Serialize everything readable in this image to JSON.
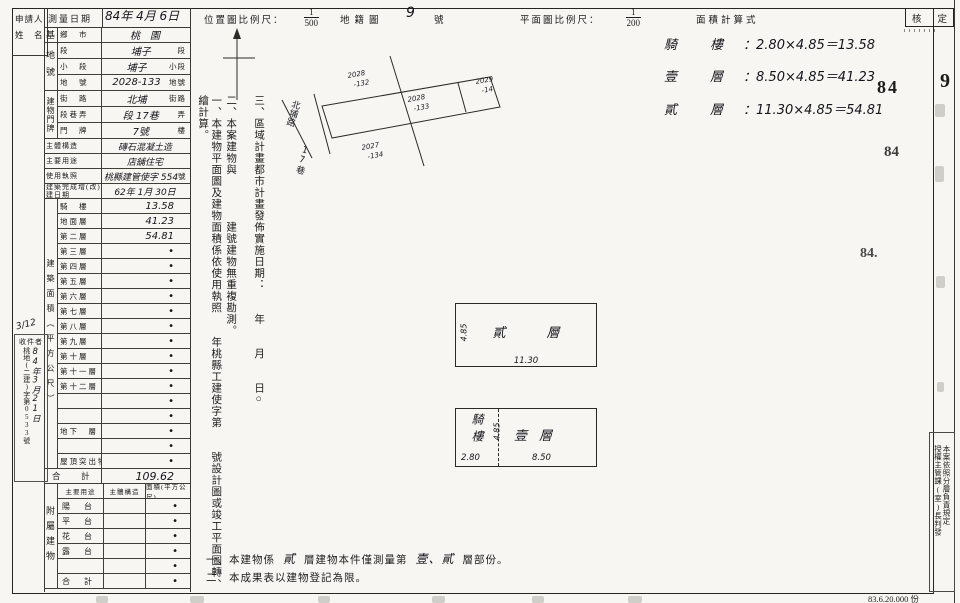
{
  "colors": {
    "paper": "#f7f6f2",
    "ink": "#1c1c1c"
  },
  "page": {
    "applicant_line1": "申請人",
    "applicant_line2": "姓　名",
    "survey_date_label": "測量日期",
    "survey_date_value": "84年 4月 6日",
    "loc_scale_label": "位置圖比例尺：",
    "loc_scale_num": "1",
    "loc_scale_den": "500",
    "cadastre_label": "地籍圖",
    "cadastre_no": "9",
    "cadastre_suffix": "號",
    "plan_scale_label": "平面圖比例尺：",
    "plan_scale_num": "1",
    "plan_scale_den": "200",
    "area_calc_title": "面積計算式",
    "approve_label_l": "核",
    "approve_label_r": "定"
  },
  "basic": {
    "groups": {
      "g1": "基",
      "g2": "地號",
      "g3": "建物門牌"
    },
    "rows": [
      {
        "label": "鄉　市",
        "vh": "桃　園",
        "vp": ""
      },
      {
        "label": "段",
        "vh": "埔子",
        "vp": "段"
      },
      {
        "label": "小　段",
        "vh": "埔子",
        "vp": "小段"
      },
      {
        "label": "地　號",
        "vh": "2028-133",
        "vp": "地號"
      },
      {
        "label": "街　路",
        "vh": "北埔",
        "vp": "街路"
      },
      {
        "label": "段巷弄",
        "vh": "段 17巷",
        "vp": "弄"
      },
      {
        "label": "門　牌",
        "vh": "7號",
        "vp": "樓"
      }
    ]
  },
  "info": {
    "rows": [
      {
        "label": "主體構造",
        "vh": "磚石混凝土造",
        "vp": ""
      },
      {
        "label": "主要用途",
        "vh": "店舖住宅",
        "vp": ""
      },
      {
        "label": "使用執照",
        "vh": "桃縣建管使字 554",
        "vp": "號"
      },
      {
        "label": "建築完成增(改)建日期",
        "vh": "62年 1月 30日",
        "vp": ""
      }
    ]
  },
  "floors": {
    "side_label": "建築面積（平方公尺）",
    "rows": [
      {
        "label": "騎　樓",
        "value": "13.58"
      },
      {
        "label": "地面層",
        "value": "41.23"
      },
      {
        "label": "第二層",
        "value": "54.81"
      },
      {
        "label": "第三層",
        "value": "•"
      },
      {
        "label": "第四層",
        "value": "•"
      },
      {
        "label": "第五層",
        "value": "•"
      },
      {
        "label": "第六層",
        "value": "•"
      },
      {
        "label": "第七層",
        "value": "•"
      },
      {
        "label": "第八層",
        "value": "•"
      },
      {
        "label": "第九層",
        "value": "•"
      },
      {
        "label": "第十層",
        "value": "•"
      },
      {
        "label": "第十一層",
        "value": "•"
      },
      {
        "label": "第十二層",
        "value": "•"
      },
      {
        "label": "",
        "value": "•"
      },
      {
        "label": "",
        "value": "•"
      },
      {
        "label": "地下　層",
        "value": "•"
      },
      {
        "label": "",
        "value": "•"
      },
      {
        "label": "屋頂突出物",
        "value": "•"
      }
    ],
    "total_label": "合　計",
    "total_value": "109.62"
  },
  "annex": {
    "side_label": "附屬建物",
    "headers": [
      "主要用途",
      "主體構造",
      "面積(平方公尺)"
    ],
    "rows": [
      {
        "label": "陽　台",
        "value": "•"
      },
      {
        "label": "平　台",
        "value": "•"
      },
      {
        "label": "花　台",
        "value": "•"
      },
      {
        "label": "露　台",
        "value": "•"
      },
      {
        "label": "",
        "value": "•"
      },
      {
        "label": "合　計",
        "value": "•"
      }
    ]
  },
  "receipt": {
    "note": "3/12",
    "title": "收件者",
    "number_col": "桃地(二建)字第0533號",
    "date_col": "84年3月21日"
  },
  "notes_vertical": {
    "n1": "一、本建物平面圖及建物面積係依使用執照　　年桃縣工建使字第　　號設計圖或竣工平面圖轉繪計算。",
    "n2": "二、本案建物與　　　　建號建物無重複勘測。",
    "n3": "三、區域計畫都市計畫發佈實施日期：　　年　　月　　日○"
  },
  "map": {
    "street": "北埔路",
    "lane": "17巷",
    "parcel_top_a": "2028",
    "parcel_top_b": "-132",
    "parcel_mid_a": "2028",
    "parcel_mid_b": "-133",
    "parcel_right_a": "2029",
    "parcel_right_b": "-14",
    "parcel_bottom_a": "2027",
    "parcel_bottom_b": "-134"
  },
  "calc": {
    "lines": [
      {
        "label": "騎　樓",
        "formula": "：2.80×4.85＝13.58"
      },
      {
        "label": "壹　層",
        "formula": "：8.50×4.85＝41.23"
      },
      {
        "label": "貳　層",
        "formula": "：11.30×4.85＝54.81"
      }
    ]
  },
  "plans": {
    "upper": {
      "label": "貳　層",
      "bottom_dim": "11.30",
      "side_dim": "4.85"
    },
    "lower": {
      "arcade": "騎樓",
      "arcade_dim": "2.80",
      "main": "壹層",
      "main_dim": "8.50",
      "side_dim": "4.85"
    }
  },
  "bottom_notes": {
    "n1a": "一、本建物係",
    "n1b": "貳",
    "n1c": "層建物本件僅測量第",
    "n1d": "壹、貳",
    "n1e": "層部份。",
    "n2": "二、本成果表以建物登記為限。"
  },
  "margin_right": {
    "page_no": "9",
    "stamp_a": "84",
    "stamp_b": "84",
    "stamp_c": "84.",
    "delegation_a": "授權主管課(室)長判發",
    "delegation_b": "本案依照分層負責規定",
    "print_info": "83.6.20.000 份"
  }
}
